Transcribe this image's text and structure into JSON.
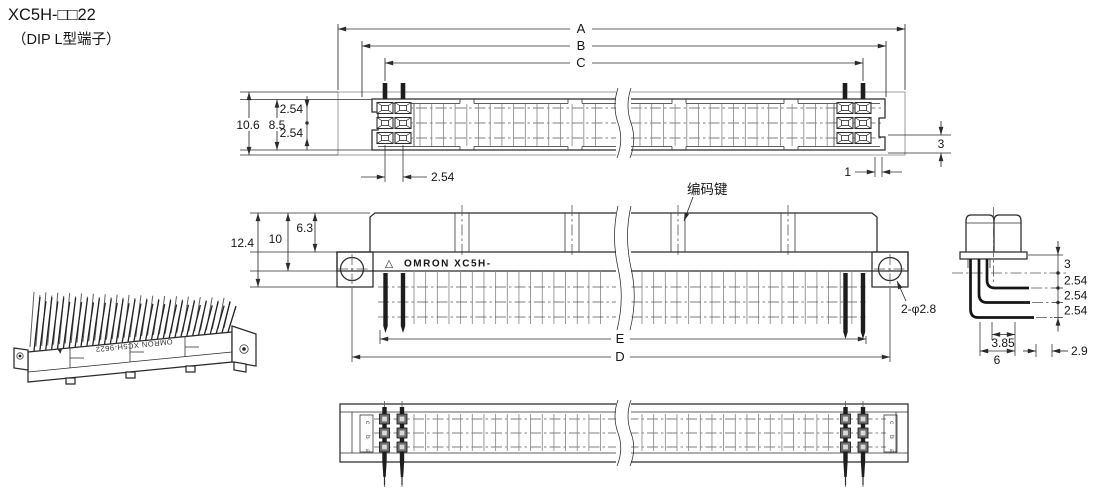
{
  "title": {
    "model": "XC5H-□□22",
    "type_note": "（DIP L型端子）"
  },
  "top_view": {
    "dim_a": "A",
    "dim_b": "B",
    "dim_c": "C",
    "height_total": "10.6",
    "height_body": "8.5",
    "row_pitch_upper": "2.54",
    "row_pitch_lower": "2.54",
    "col_pitch": "2.54",
    "edge_offset_v": "3",
    "edge_offset_h": "1"
  },
  "side_view": {
    "height_total": "12.4",
    "height_body": "10",
    "height_mating": "6.3",
    "coding_key": "编码键",
    "marking": "OMRON XC5H-",
    "marking_triangle": "△",
    "holes": "2-φ2.8",
    "dim_e": "E",
    "dim_d": "D"
  },
  "profile_view": {
    "seat_height": "3",
    "row_pitch_1": "2.54",
    "row_pitch_2": "2.54",
    "row_pitch_3": "2.54",
    "bend_width": "3.85",
    "depth": "6",
    "tip_length": "2.9"
  },
  "bottom_view": {
    "row_label_c": "c",
    "row_label_b": "b",
    "row_label_a": "a"
  },
  "isometric": {
    "marking": "OMRON XC5H-9622",
    "marking_triangle": "▲"
  }
}
